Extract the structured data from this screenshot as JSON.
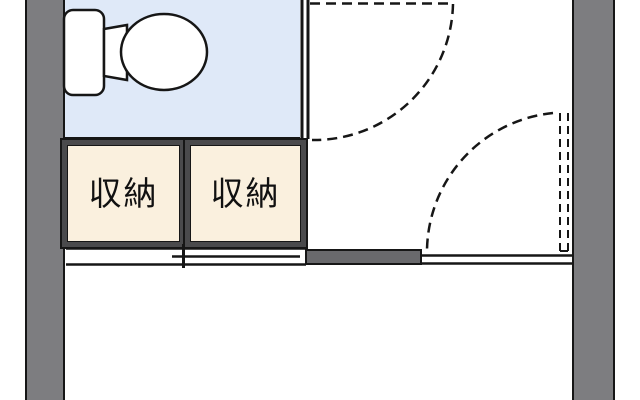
{
  "title": "apartment-floorplan-section",
  "rooms": {
    "toilet_room": {
      "fixture": "toilet-icon",
      "fill": "#dfe9f8"
    },
    "closets": [
      {
        "label": "収納",
        "fill": "#faf0de",
        "frame": "#4a4a4c"
      },
      {
        "label": "収納",
        "fill": "#faf0de",
        "frame": "#4a4a4c"
      }
    ]
  },
  "doors": {
    "top_door": "dashed-swing-arc",
    "right_wall_door": "dashed-swing-arc-with-dashed-panel",
    "closet_door": "sliding-double-track"
  },
  "colors": {
    "wall_gray": "#7d7d80",
    "partition_gray": "#69696c",
    "line_black": "#161616",
    "toilet_room_blue": "#dfe9f8",
    "closet_cream": "#faf0de",
    "closet_frame_dark": "#4a4a4c",
    "background": "#ffffff"
  }
}
